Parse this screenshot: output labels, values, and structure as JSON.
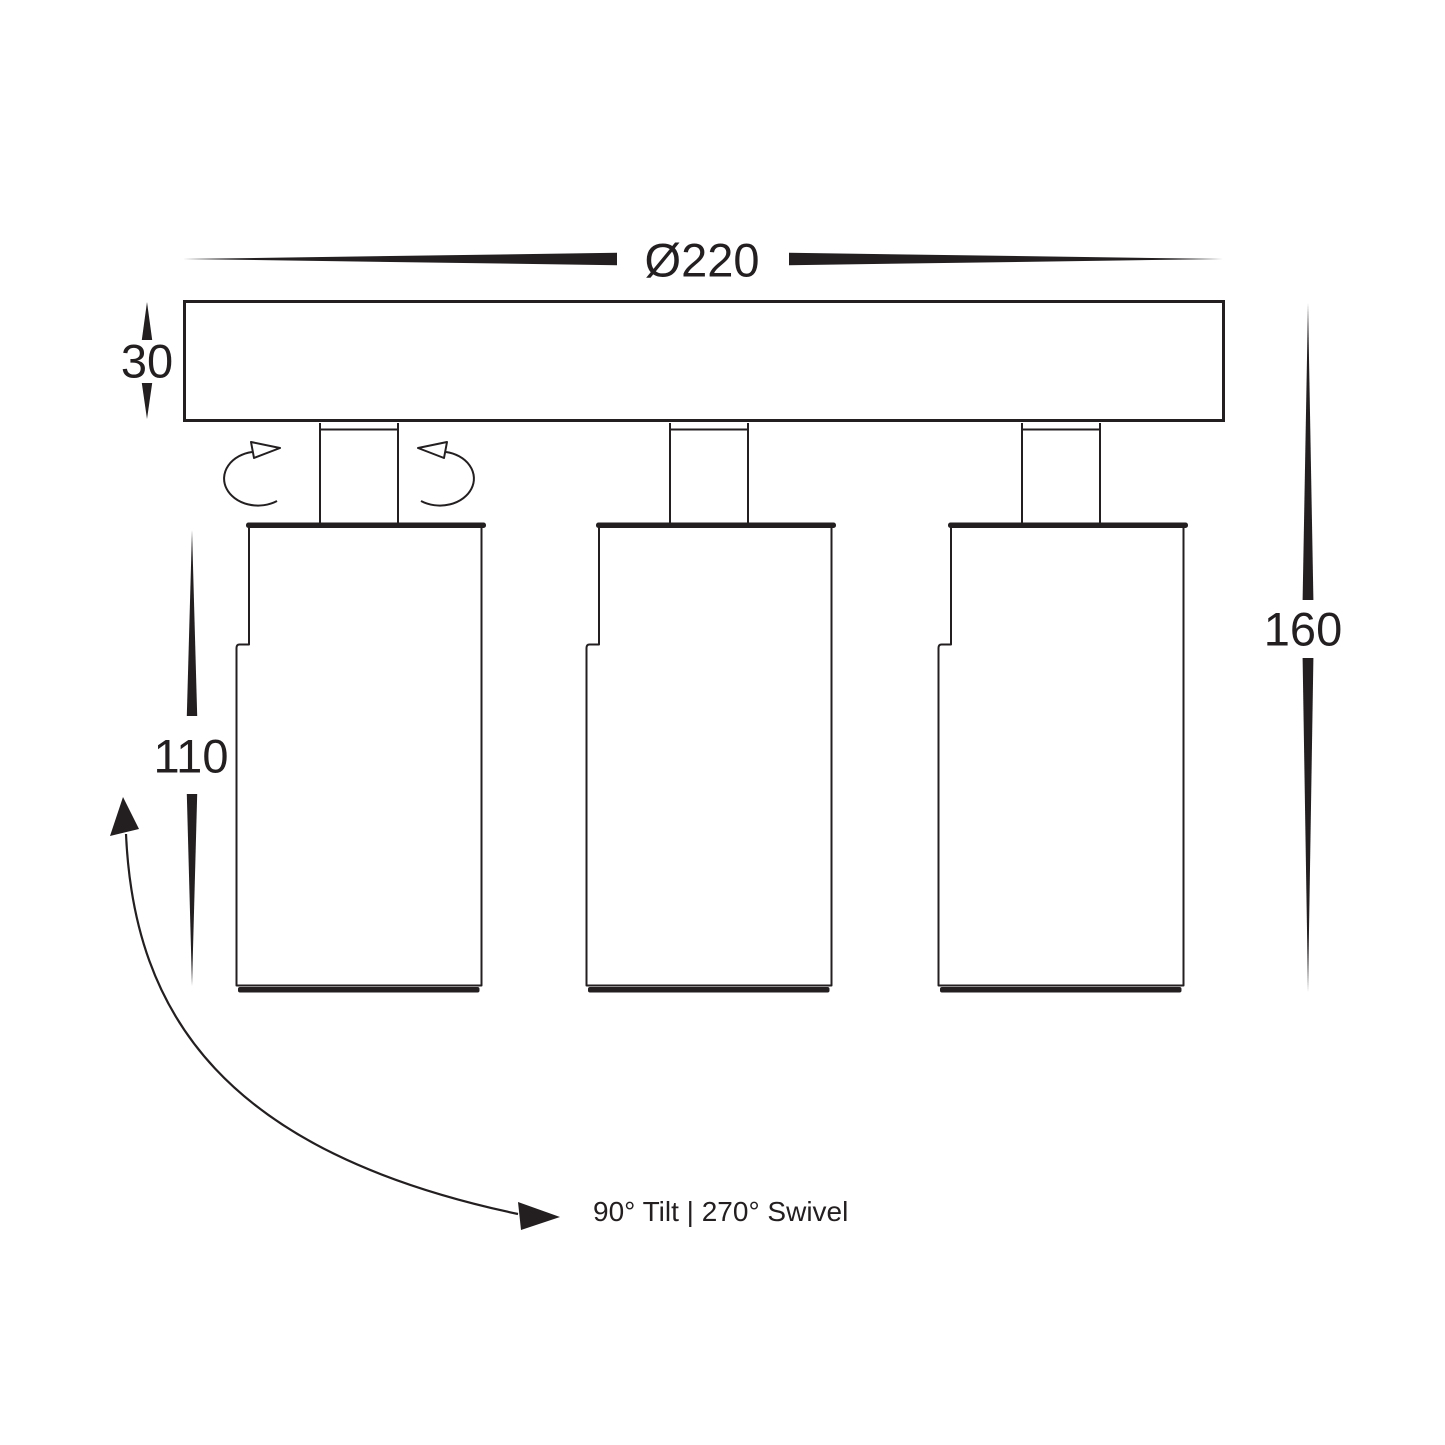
{
  "drawing": {
    "type": "technical-dimension-diagram",
    "product": "three-head ceiling spotlight bar",
    "fixture_count": 3,
    "dimensions": {
      "diameter": "Ø220",
      "plate_thickness": "30",
      "body_height": "110",
      "overall_height": "160"
    },
    "adjustability_note": "90° Tilt | 270° Swivel",
    "colors": {
      "line": "#231f20",
      "background": "#ffffff"
    }
  }
}
